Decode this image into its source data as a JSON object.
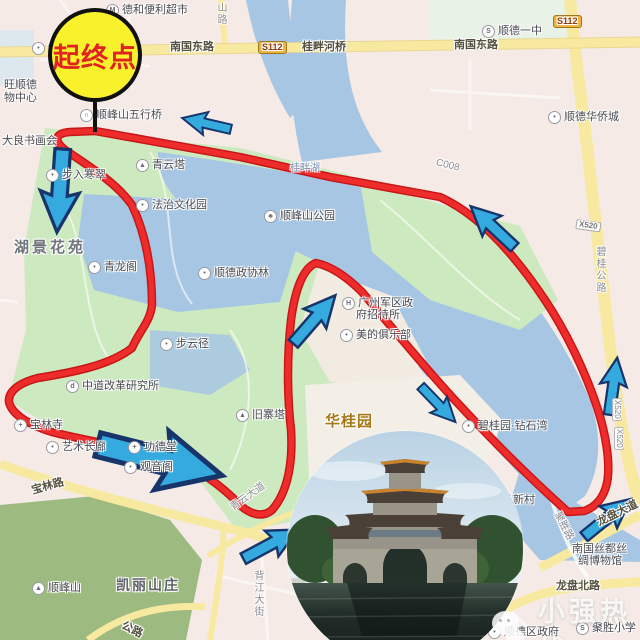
{
  "start_marker": {
    "label": "起终点"
  },
  "watermark": {
    "text": "小强热线",
    "icon": "wechat-icon"
  },
  "map": {
    "colors": {
      "route": "#e02020",
      "water": "#a6c6e3",
      "park": "#cde9bf",
      "hill": "#9dbb80",
      "road": "#f8e9a1",
      "arrow": "#35aadf",
      "arrow_outline": "#17356b",
      "start_fill": "#f8f12b",
      "start_text": "#e02222"
    },
    "icon_glyphs": {
      "dot-icon": "•",
      "m-icon": "M",
      "school-icon": "S",
      "pagoda-icon": "▲",
      "temple-icon": "+",
      "tree-icon": "♣",
      "hotel-icon": "H",
      "d-icon": "d",
      "bridge-icon": "∩",
      "mtn-icon": "▲"
    },
    "labels": [
      {
        "t": "德和便利超市",
        "x": 106,
        "y": 4,
        "k": "poi",
        "i": "m-icon"
      },
      {
        "t": "山路",
        "x": 215,
        "y": 2,
        "k": "vertg"
      },
      {
        "t": "恒龙",
        "x": 32,
        "y": 42,
        "k": "poi",
        "i": "dot-icon"
      },
      {
        "t": "南国东路",
        "x": 170,
        "y": 42,
        "k": "road"
      },
      {
        "t": "S112",
        "x": 258,
        "y": 41,
        "k": "badge_s"
      },
      {
        "t": "桂畔河桥",
        "x": 302,
        "y": 42,
        "k": "road"
      },
      {
        "t": "南国东路",
        "x": 454,
        "y": 40,
        "k": "road"
      },
      {
        "t": "S112",
        "x": 553,
        "y": 15,
        "k": "badge_s"
      },
      {
        "t": "顺德一中",
        "x": 482,
        "y": 25,
        "k": "poi",
        "i": "school-icon"
      },
      {
        "t": "旺顺德",
        "x": 4,
        "y": 80,
        "k": "poi2"
      },
      {
        "t": "物中心",
        "x": 4,
        "y": 93,
        "k": "poi2"
      },
      {
        "t": "顺德华侨城",
        "x": 548,
        "y": 111,
        "k": "poi",
        "i": "dot-icon"
      },
      {
        "t": "顺峰山五行桥",
        "x": 80,
        "y": 109,
        "k": "poi",
        "i": "bridge-icon"
      },
      {
        "t": "大良书画会",
        "x": 2,
        "y": 136,
        "k": "poi2"
      },
      {
        "t": "青云塔",
        "x": 136,
        "y": 159,
        "k": "poi",
        "i": "pagoda-icon"
      },
      {
        "t": "步入寒翠",
        "x": 46,
        "y": 169,
        "k": "poi",
        "i": "dot-icon"
      },
      {
        "t": "桂畔湖",
        "x": 290,
        "y": 164,
        "k": "water"
      },
      {
        "t": "C008",
        "x": 436,
        "y": 158,
        "k": "roadg",
        "r": 14
      },
      {
        "t": "湖景花苑",
        "x": 14,
        "y": 240,
        "k": "area"
      },
      {
        "t": "法治文化园",
        "x": 136,
        "y": 199,
        "k": "poi",
        "i": "dot-icon"
      },
      {
        "t": "顺峰山公园",
        "x": 264,
        "y": 210,
        "k": "poi",
        "i": "tree-icon"
      },
      {
        "t": "X520",
        "x": 576,
        "y": 219,
        "k": "badge_x",
        "r": 8
      },
      {
        "t": "碧桂公路",
        "x": 594,
        "y": 246,
        "k": "vertg"
      },
      {
        "t": "青龙阁",
        "x": 88,
        "y": 261,
        "k": "poi",
        "i": "dot-icon"
      },
      {
        "t": "顺德政协林",
        "x": 198,
        "y": 267,
        "k": "poi",
        "i": "dot-icon"
      },
      {
        "t": "步云径",
        "x": 160,
        "y": 338,
        "k": "poi",
        "i": "dot-icon"
      },
      {
        "t": "广州军区政",
        "x": 342,
        "y": 297,
        "k": "poi",
        "i": "hotel-icon"
      },
      {
        "t": "府招待所",
        "x": 356,
        "y": 310,
        "k": "poi2"
      },
      {
        "t": "美的俱乐部",
        "x": 340,
        "y": 329,
        "k": "poi",
        "i": "dot-icon"
      },
      {
        "t": "中道改革研究所",
        "x": 66,
        "y": 380,
        "k": "poi",
        "i": "d-icon"
      },
      {
        "t": "宝林寺",
        "x": 14,
        "y": 419,
        "k": "poi",
        "i": "temple-icon"
      },
      {
        "t": "艺术长廊",
        "x": 46,
        "y": 441,
        "k": "poi",
        "i": "dot-icon"
      },
      {
        "t": "功德堂",
        "x": 128,
        "y": 441,
        "k": "poi",
        "i": "temple-icon"
      },
      {
        "t": "观音阁",
        "x": 124,
        "y": 461,
        "k": "poi",
        "i": "dot-icon"
      },
      {
        "t": "旧寨塔",
        "x": 236,
        "y": 409,
        "k": "poi",
        "i": "pagoda-icon"
      },
      {
        "t": "华桂园",
        "x": 325,
        "y": 414,
        "k": "areao"
      },
      {
        "t": "宝林路",
        "x": 32,
        "y": 486,
        "k": "road",
        "r": -16
      },
      {
        "t": "碧桂园·钻石湾",
        "x": 462,
        "y": 420,
        "k": "poi",
        "i": "dot-icon"
      },
      {
        "t": "X520",
        "x": 612,
        "y": 398,
        "k": "vertx"
      },
      {
        "t": "X520",
        "x": 614,
        "y": 427,
        "k": "vertx"
      },
      {
        "t": "马新村",
        "x": 502,
        "y": 495,
        "k": "poi2"
      },
      {
        "t": "聚胜路",
        "x": 556,
        "y": 508,
        "k": "roadg",
        "r": 62
      },
      {
        "t": "龙盘大道",
        "x": 598,
        "y": 518,
        "k": "road",
        "r": -26
      },
      {
        "t": "南国丝都丝",
        "x": 572,
        "y": 544,
        "k": "poi2"
      },
      {
        "t": "绸博物馆",
        "x": 578,
        "y": 556,
        "k": "poi2"
      },
      {
        "t": "龙盘北路",
        "x": 556,
        "y": 581,
        "k": "road"
      },
      {
        "t": "聚胜小学",
        "x": 576,
        "y": 622,
        "k": "poi",
        "i": "school-icon"
      },
      {
        "t": "顺德区政府",
        "x": 488,
        "y": 626,
        "k": "poi",
        "i": "dot-icon"
      },
      {
        "t": "凯丽山庄",
        "x": 116,
        "y": 578,
        "k": "area2"
      },
      {
        "t": "顺峰山",
        "x": 32,
        "y": 582,
        "k": "poi",
        "i": "mtn-icon"
      },
      {
        "t": "背江大街",
        "x": 252,
        "y": 570,
        "k": "vertg"
      },
      {
        "t": "青云大道",
        "x": 232,
        "y": 504,
        "k": "roadg",
        "r": -36
      },
      {
        "t": "公路",
        "x": 122,
        "y": 620,
        "k": "road",
        "r": 26
      }
    ],
    "arrows": [
      {
        "x": 208,
        "y": 124,
        "a": 193,
        "s": 0.78
      },
      {
        "x": 60,
        "y": 188,
        "a": 94,
        "s": 1.3
      },
      {
        "x": 494,
        "y": 228,
        "a": -137,
        "s": 0.94
      },
      {
        "x": 313,
        "y": 321,
        "a": -49,
        "s": 1.0
      },
      {
        "x": 437,
        "y": 403,
        "a": 46,
        "s": 0.78
      },
      {
        "x": 156,
        "y": 459,
        "a": 14,
        "s": 2.0
      },
      {
        "x": 269,
        "y": 545,
        "a": -28,
        "s": 0.97
      },
      {
        "x": 606,
        "y": 519,
        "a": -39,
        "s": 0.94
      },
      {
        "x": 613,
        "y": 388,
        "a": -82,
        "s": 0.9
      }
    ]
  }
}
